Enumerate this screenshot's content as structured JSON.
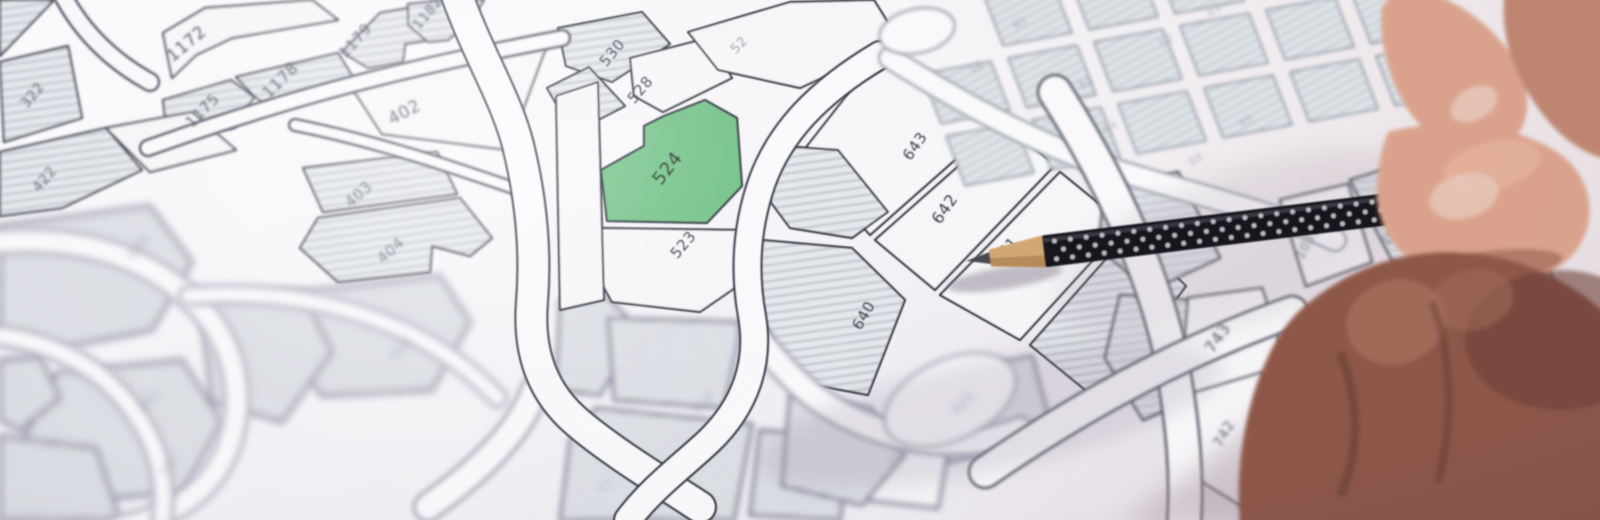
{
  "scene": {
    "title": "Photographed cadastral parcel map with parcel 524 highlighted in green and a hand pointing with a black pencil",
    "highlighted_parcel": "524"
  },
  "palette": {
    "ink": "#3a4050",
    "green": "#72c287",
    "greenInk": "#25352c",
    "parcelWhite": "#f8f7f9",
    "roadWhite": "#fbfafc",
    "labelColors": {
      "a": "#3a4050",
      "tl": "#444a5c",
      "ll": "#7c7a92",
      "bc": "#7c7a92",
      "gr": "#7a8095",
      "rt": "#4a5062"
    }
  },
  "zones": {
    "a": {
      "stroke": "#2b313d",
      "sw": 2.2
    },
    "tl": {
      "stroke": "#30364a",
      "sw": 2.2
    },
    "ll": {
      "stroke": "#a39fb4",
      "sw": 5
    },
    "bc": {
      "stroke": "#8f8da4",
      "sw": 4
    },
    "gr": {
      "stroke": "#9aa0ae",
      "sw": 2
    },
    "rt": {
      "stroke": "#3f4554",
      "sw": 2.6
    }
  },
  "map": {
    "parcels": [
      {
        "l": "1172",
        "p": "163,33 205,8 312,0 338,20 232,38 196,55 172,78",
        "f": "w",
        "z": "tl",
        "lp": [
          190,
          48
        ],
        "r": -40,
        "fs": 17
      },
      {
        "l": "1175",
        "p": "163,100 231,80 254,97 234,128 188,133 165,117",
        "f": "h",
        "z": "tl",
        "lp": [
          206,
          114
        ],
        "r": -45,
        "fs": 15
      },
      {
        "l": "1178",
        "p": "236,77 338,53 357,84 270,108 254,96",
        "f": "h",
        "z": "tl",
        "lp": [
          284,
          84
        ],
        "r": -45,
        "fs": 16
      },
      {
        "l": "1179",
        "p": "342,52 380,13 420,6 443,22 430,40 405,44 403,62 368,68",
        "f": "h",
        "z": "tl",
        "lp": [
          359,
          44
        ],
        "r": -48,
        "fs": 15
      },
      {
        "l": "1182",
        "p": "408,4 448,0 484,0 470,22 448,40 428,42 408,25",
        "f": "h",
        "z": "tl",
        "lp": [
          431,
          16
        ],
        "r": -50,
        "fs": 14
      },
      {
        "l": "402",
        "p": "352,88 548,42 508,150 382,134",
        "f": "w",
        "z": "tl",
        "lp": [
          407,
          117
        ],
        "r": -28,
        "fs": 17
      },
      {
        "l": "403",
        "p": "303,168 437,152 457,194 323,212",
        "f": "h",
        "z": "tl",
        "lp": [
          362,
          198
        ],
        "r": -42,
        "fs": 15,
        "lo": 0.8
      },
      {
        "l": "404",
        "p": "300,248 318,218 460,198 492,238 470,256 432,246 430,272 338,282",
        "f": "h",
        "z": "tl",
        "lp": [
          394,
          254
        ],
        "r": -42,
        "fs": 15,
        "lo": 0.7
      },
      {
        "l": "405",
        "p": "298,292 440,276 470,322 432,390 322,396 282,342",
        "f": "h",
        "z": "ll",
        "lp": [
          404,
          352
        ],
        "r": -42,
        "fs": 14,
        "lo": 0.5
      },
      {
        "l": "322",
        "p": "0,62 68,46 82,118 4,142",
        "f": "h",
        "z": "tl",
        "lp": [
          36,
          98
        ],
        "r": -50,
        "fs": 14,
        "lo": 0.85
      },
      {
        "l": "422",
        "p": "0,152 106,128 142,170 62,208 0,216",
        "f": "h",
        "z": "tl",
        "lp": [
          48,
          182
        ],
        "r": -50,
        "fs": 14,
        "lo": 0.8
      },
      {
        "p": "106,128 192,112 236,150 150,172",
        "f": "w",
        "z": "tl"
      },
      {
        "p": "0,0 54,0 0,56",
        "f": "h",
        "z": "tl"
      },
      {
        "l": "435",
        "p": "0,226 150,206 192,262 152,330 42,352 0,340",
        "f": "h",
        "z": "ll",
        "lp": [
          142,
          250
        ],
        "r": -50,
        "fs": 14,
        "lo": 0.6
      },
      {
        "l": "465",
        "p": "58,372 182,360 222,422 182,492 72,502 22,442",
        "f": "h",
        "z": "ll",
        "lp": [
          152,
          404
        ],
        "r": -45,
        "fs": 13,
        "lo": 0.45
      },
      {
        "p": "200,300 302,290 332,352 282,422 212,402",
        "f": "h",
        "z": "ll"
      },
      {
        "p": "0,360 40,356 60,398 20,430 0,420",
        "f": "h",
        "z": "ll"
      },
      {
        "p": "0,436 96,448 120,520 0,520",
        "f": "h",
        "z": "ll"
      },
      {
        "p": "560,300 600,290 640,330 600,395 556,390",
        "f": "h",
        "z": "bc"
      },
      {
        "l": "910",
        "p": "608,318 742,322 724,408 614,400",
        "f": "h",
        "z": "bc",
        "lp": [
          706,
          406
        ],
        "r": -45,
        "fs": 13,
        "lo": 0.45
      },
      {
        "p": "596,408 752,424 734,520 560,520 570,440",
        "f": "h",
        "z": "bc"
      },
      {
        "l": "601",
        "p": "852,418 952,428 938,508 846,498",
        "f": "w",
        "z": "bc",
        "lp": [
          903,
          458
        ],
        "r": -45,
        "fs": 13,
        "lo": 0.5
      },
      {
        "l": "625",
        "p": "928,378 1032,356 1054,438 948,462",
        "f": "h",
        "z": "bc",
        "lp": [
          966,
          406
        ],
        "r": -45,
        "fs": 13,
        "lo": 0.5
      },
      {
        "p": "760,430 850,440 840,520 750,515",
        "f": "h",
        "z": "bc"
      },
      {
        "p": "790,395 870,408 905,455 862,505 782,486",
        "f": "h",
        "z": "bc"
      },
      {
        "l": "530",
        "p": "558,28 642,12 670,44 612,82 566,66",
        "f": "h",
        "z": "a",
        "lp": [
          616,
          56
        ],
        "r": -50,
        "fs": 15
      },
      {
        "p": "547,88 589,67 625,106 573,133",
        "f": "h",
        "z": "a"
      },
      {
        "l": "528",
        "p": "630,58 708,38 732,78 663,112 634,96",
        "f": "w",
        "z": "a",
        "lp": [
          644,
          93
        ],
        "r": -50,
        "fs": 15
      },
      {
        "l": "52",
        "p": "688,32 790,2 874,0 900,42 800,88 718,70",
        "f": "w",
        "z": "a",
        "lp": [
          742,
          48
        ],
        "r": -45,
        "fs": 13,
        "lo": 0.45
      },
      {
        "l": "524",
        "p": "705,100 737,118 742,186 707,223 607,221 601,170 644,146 644,126 664,116",
        "f": "g",
        "z": "a",
        "lp": [
          672,
          172
        ],
        "r": -52,
        "fs": 18,
        "lc": "#25352c"
      },
      {
        "l": "523",
        "p": "600,228 742,230 758,272 700,312 612,302 590,262",
        "f": "w",
        "z": "a",
        "lp": [
          687,
          248
        ],
        "r": -50,
        "fs": 15
      },
      {
        "p": "556,96 598,82 604,300 560,310",
        "f": "w",
        "z": "a"
      },
      {
        "l": "643",
        "p": "800,155 855,85 895,62 960,88 1000,120 870,235",
        "f": "w",
        "z": "a",
        "lp": [
          919,
          149
        ],
        "r": -55,
        "fs": 15
      },
      {
        "l": "642",
        "p": "875,240 1005,125 1055,165 935,290",
        "f": "w",
        "z": "a",
        "lp": [
          949,
          212
        ],
        "r": -55,
        "fs": 16
      },
      {
        "l": "641",
        "p": "940,295 1060,172 1125,225 1020,340",
        "f": "w",
        "z": "a",
        "lp": [
          1009,
          254
        ],
        "r": -50,
        "fs": 15
      },
      {
        "p": "770,145 838,150 888,212 852,238 790,228 758,185",
        "f": "h",
        "z": "a"
      },
      {
        "l": "640",
        "p": "762,240 852,248 905,300 868,395 798,382 752,300",
        "f": "h",
        "z": "a",
        "lp": [
          868,
          318
        ],
        "r": -60,
        "fs": 15
      },
      {
        "p": "1030,345 1130,232 1186,286 1100,402",
        "f": "h",
        "z": "a"
      },
      {
        "p": "1105,190 1178,172 1220,258 1150,290 1098,248",
        "f": "h",
        "z": "rt"
      },
      {
        "p": "1120,295 1188,300 1212,390 1143,420 1105,358",
        "f": "h",
        "z": "rt"
      },
      {
        "l": "743",
        "p": "1188,298 1262,288 1292,382 1235,432 1180,392",
        "f": "w",
        "z": "rt",
        "lp": [
          1222,
          341
        ],
        "r": -55,
        "fs": 16
      },
      {
        "l": "742",
        "p": "1175,398 1262,372 1302,452 1240,505 1170,462",
        "f": "w",
        "z": "rt",
        "lp": [
          1228,
          436
        ],
        "r": -60,
        "fs": 14,
        "lo": 0.85
      },
      {
        "l": "1031",
        "p": "1280,200 1348,184 1372,262 1306,286",
        "f": "w",
        "z": "rt",
        "lp": [
          1311,
          245
        ],
        "r": -60,
        "fs": 13,
        "lo": 0.75
      },
      {
        "l": "1030",
        "p": "1350,180 1432,155 1472,230 1396,268",
        "f": "h",
        "z": "rt",
        "lp": [
          1398,
          232
        ],
        "r": -55,
        "fs": 13,
        "lo": 0.7
      },
      {
        "l": "1039",
        "p": "1290,322 1368,292 1422,380 1396,470 1310,452",
        "f": "h",
        "z": "rt",
        "lp": [
          1348,
          396
        ],
        "r": -63,
        "fs": 15,
        "lo": 0.9
      },
      {
        "p": "1440,240 1530,215 1560,300 1470,330",
        "f": "h",
        "z": "rt"
      },
      {
        "p": "1300,470 1390,480 1380,520 1290,520",
        "f": "h",
        "z": "rt"
      }
    ],
    "grid": {
      "o": [
        898,
        12
      ],
      "u": [
        86,
        -16
      ],
      "v": [
        24,
        62
      ],
      "cols": 6,
      "rows": 3,
      "cw": 0.8,
      "rh": 0.8,
      "skip": [
        [
          0,
          0
        ]
      ]
    },
    "roundabout": {
      "cx": 917,
      "cy": 31,
      "rx": 38,
      "ry": 22,
      "rot": -12
    },
    "roads": [
      {
        "d": "M0,242 C80,236 142,256 188,296 C234,336 246,392 230,442 C214,492 172,516 120,528",
        "w": 22,
        "z": "ll"
      },
      {
        "d": "M0,336 C62,344 112,374 142,424 C160,452 166,486 162,520",
        "w": 18,
        "z": "ll"
      },
      {
        "d": "M188,296 C262,290 334,300 402,330 C440,347 470,370 498,398",
        "w": 16,
        "z": "ll"
      },
      {
        "d": "M535,390 C520,432 478,472 428,507",
        "w": 26,
        "z": "bc"
      },
      {
        "d": "M752,330 C790,380 820,410 880,430 C930,446 980,446 1020,430",
        "w": 24,
        "z": "bc"
      },
      {
        "tag": "ellipse",
        "at": {
          "cx": 950,
          "cy": 400,
          "rx": 70,
          "ry": 40,
          "transform": "rotate(-25 950 400)",
          "fill": "#fafafc",
          "stroke": "#8f8da4",
          "stroke-width": 2.5
        },
        "z": "bc",
        "n": "road-junction"
      },
      {
        "d": "M295,125 C380,142 455,168 525,192",
        "w": 10,
        "z": "tl"
      },
      {
        "d": "M148,148 C250,112 360,76 562,38",
        "w": 14,
        "z": "tl"
      },
      {
        "d": "M60,-10 C80,30 110,60 150,82",
        "w": 16,
        "z": "tl"
      },
      {
        "d": "M455,-10 C480,60 505,95 518,145 C531,198 536,252 532,302 C528,352 542,392 577,422 C612,452 662,482 700,507",
        "w": 30,
        "z": "a"
      },
      {
        "d": "M880,55 C818,92 780,132 762,182 C746,228 744,272 752,316 C760,362 746,406 708,442 C680,468 650,490 628,520",
        "w": 26,
        "z": "a"
      },
      {
        "d": "M908,-12 C902,10 902,30 908,50",
        "w": 16,
        "z": "gr"
      },
      {
        "d": "M890,58 C965,105 1042,147 1122,172 C1205,197 1272,212 1335,240",
        "w": 20,
        "z": "gr"
      },
      {
        "d": "M1055,92 C1105,170 1150,262 1170,352 C1185,432 1187,482 1184,525",
        "w": 32,
        "z": "rt"
      },
      {
        "d": "M985,472 C1075,410 1178,352 1292,312",
        "w": 30,
        "z": "rt"
      }
    ],
    "extra_labels": [
      {
        "t": "485",
        "lp": [
          173,
          468
        ],
        "r": -45,
        "fs": 13,
        "o": 0.35,
        "z": "ll"
      },
      {
        "t": "91",
        "lp": [
          608,
          488
        ],
        "r": -45,
        "fs": 12,
        "o": 0.35,
        "z": "bc"
      },
      {
        "t": "91",
        "lp": [
          1022,
          26
        ],
        "r": -30,
        "fs": 11,
        "o": 0.5,
        "z": "gr"
      },
      {
        "t": "16",
        "lp": [
          978,
          70
        ],
        "r": -30,
        "fs": 11,
        "o": 0.5,
        "z": "gr"
      },
      {
        "t": "82",
        "lp": [
          1088,
          86
        ],
        "r": -30,
        "fs": 11,
        "o": 0.5,
        "z": "gr"
      },
      {
        "t": "52",
        "lp": [
          1168,
          44
        ],
        "r": -30,
        "fs": 11,
        "o": 0.45,
        "z": "gr"
      },
      {
        "t": "64",
        "lp": [
          1112,
          130
        ],
        "r": -30,
        "fs": 11,
        "o": 0.45,
        "z": "gr"
      },
      {
        "t": "93",
        "lp": [
          1216,
          14
        ],
        "r": -30,
        "fs": 11,
        "o": 0.45,
        "z": "gr"
      },
      {
        "t": "95",
        "lp": [
          1248,
          124
        ],
        "r": -30,
        "fs": 11,
        "o": 0.4,
        "z": "gr"
      },
      {
        "t": "88",
        "lp": [
          1198,
          162
        ],
        "r": -35,
        "fs": 11,
        "o": 0.4,
        "z": "gr"
      }
    ]
  },
  "shadows": [
    {
      "tag": "ellipse",
      "at": {
        "cx": 990,
        "cy": 415,
        "rx": 235,
        "ry": 56,
        "transform": "rotate(-12 990 415)",
        "fill": "#8a7f96",
        "opacity": 0.2,
        "filter": "url(#f-b10)"
      },
      "n": "hand-shadow-band"
    },
    {
      "tag": "ellipse",
      "at": {
        "cx": 1250,
        "cy": 245,
        "rx": 200,
        "ry": 75,
        "transform": "rotate(-18 1250 245)",
        "fill": "#a192a0",
        "opacity": 0.2,
        "filter": "url(#f-b14)"
      },
      "n": "ambient-shadow"
    },
    {
      "tag": "polygon",
      "at": {
        "points": "1120,525 1335,368 1610,428 1610,525",
        "fill": "#9b8492",
        "opacity": 0.42,
        "filter": "url(#f-b14)"
      },
      "n": "hand-shadow"
    },
    {
      "tag": "ellipse",
      "at": {
        "cx": 1005,
        "cy": 278,
        "rx": 58,
        "ry": 11,
        "transform": "rotate(-9 1005 278)",
        "fill": "#6d6478",
        "opacity": 0.4,
        "filter": "url(#f-b3)"
      },
      "n": "pencil-shadow"
    },
    {
      "tag": "path",
      "at": {
        "d": "M1448,525 L1566,428",
        "stroke": "#d9cdd3",
        "stroke-width": 3,
        "opacity": 0.8,
        "fill": "none",
        "filter": "url(#f-b2)"
      },
      "n": "paper-edge"
    }
  ],
  "pencil": {
    "tip": [
      990,
      258
    ],
    "angle": -7,
    "len": 430,
    "body": "#17181d",
    "dots": "#c9cbd1",
    "wood": "#d3a873",
    "woodShade": "#ab7f50",
    "lead": "#4a4a50",
    "sheen": "#3c3d44"
  },
  "hand": {
    "shapes": [
      {
        "tag": "path",
        "at": {
          "d": "M1398,-15 C1448,-8 1492,22 1516,62 C1534,95 1530,130 1506,146 C1478,162 1440,150 1414,118 C1390,88 1378,40 1382,8 Z",
          "fill": "#dca48e"
        },
        "n": "index-finger"
      },
      {
        "tag": "ellipse",
        "at": {
          "cx": 1474,
          "cy": 104,
          "rx": 25,
          "ry": 16,
          "transform": "rotate(-28 1474 104)",
          "fill": "#e8cabc",
          "opacity": 0.85
        },
        "n": "index-fingernail"
      },
      {
        "tag": "path",
        "at": {
          "d": "M1506,-15 L1610,-15 L1610,160 C1570,152 1540,118 1520,78 C1505,48 1500,14 1506,-15 Z",
          "fill": "#c08873"
        },
        "n": "hand-side"
      },
      {
        "tag": "path",
        "at": {
          "d": "M1388,132 C1440,118 1508,122 1554,150 C1590,172 1600,214 1578,248 C1550,288 1488,292 1436,274 C1396,260 1374,222 1377,186 C1379,158 1383,144 1388,132 Z",
          "fill": "#dca48e"
        },
        "n": "thumb"
      },
      {
        "tag": "ellipse",
        "at": {
          "cx": 1492,
          "cy": 166,
          "rx": 50,
          "ry": 24,
          "transform": "rotate(-14 1492 166)",
          "fill": "#eebfa6",
          "opacity": 0.45
        },
        "n": "thumb-highlight"
      },
      {
        "tag": "ellipse",
        "at": {
          "cx": 1464,
          "cy": 196,
          "rx": 35,
          "ry": 22,
          "transform": "rotate(-15 1464 196)",
          "fill": "#e8cabc",
          "opacity": 0.8
        },
        "n": "thumbnail"
      },
      {
        "tag": "ellipse",
        "at": {
          "cx": 1478,
          "cy": 268,
          "rx": 85,
          "ry": 16,
          "transform": "rotate(-7 1478 268)",
          "fill": "#8f584a",
          "opacity": 0.55
        },
        "n": "thumb-crease"
      },
      {
        "tag": "path",
        "at": {
          "d": "M1296,314 C1340,272 1398,250 1454,252 C1518,254 1574,282 1610,318 L1610,525 L1240,525 C1235,470 1245,410 1263,368 C1273,344 1283,328 1296,314 Z",
          "fill": "#8f584a"
        },
        "n": "curled-fingers"
      },
      {
        "tag": "ellipse",
        "at": {
          "cx": 1560,
          "cy": 340,
          "rx": 95,
          "ry": 70,
          "fill": "#6e4138",
          "opacity": 0.6
        },
        "n": "finger-shading"
      },
      {
        "tag": "ellipse",
        "at": {
          "cx": 1396,
          "cy": 322,
          "rx": 50,
          "ry": 42,
          "transform": "rotate(-15 1396 322)",
          "fill": "#b37c66",
          "opacity": 0.55
        },
        "n": "knuckle-highlight"
      },
      {
        "tag": "ellipse",
        "at": {
          "cx": 1472,
          "cy": 300,
          "rx": 42,
          "ry": 30,
          "transform": "rotate(-12 1472 300)",
          "fill": "#a56f5b",
          "opacity": 0.5
        },
        "n": "knuckle-highlight-2"
      },
      {
        "tag": "path",
        "at": {
          "d": "M1340,352 C1360,402 1360,452 1340,496",
          "stroke": "#5d352c",
          "stroke-width": 9,
          "fill": "none",
          "opacity": 0.45
        },
        "n": "finger-crease-line"
      },
      {
        "tag": "path",
        "at": {
          "d": "M1432,302 C1452,352 1454,422 1438,482",
          "stroke": "#5d352c",
          "stroke-width": 8,
          "fill": "none",
          "opacity": 0.38
        },
        "n": "finger-crease-line-2"
      }
    ]
  }
}
